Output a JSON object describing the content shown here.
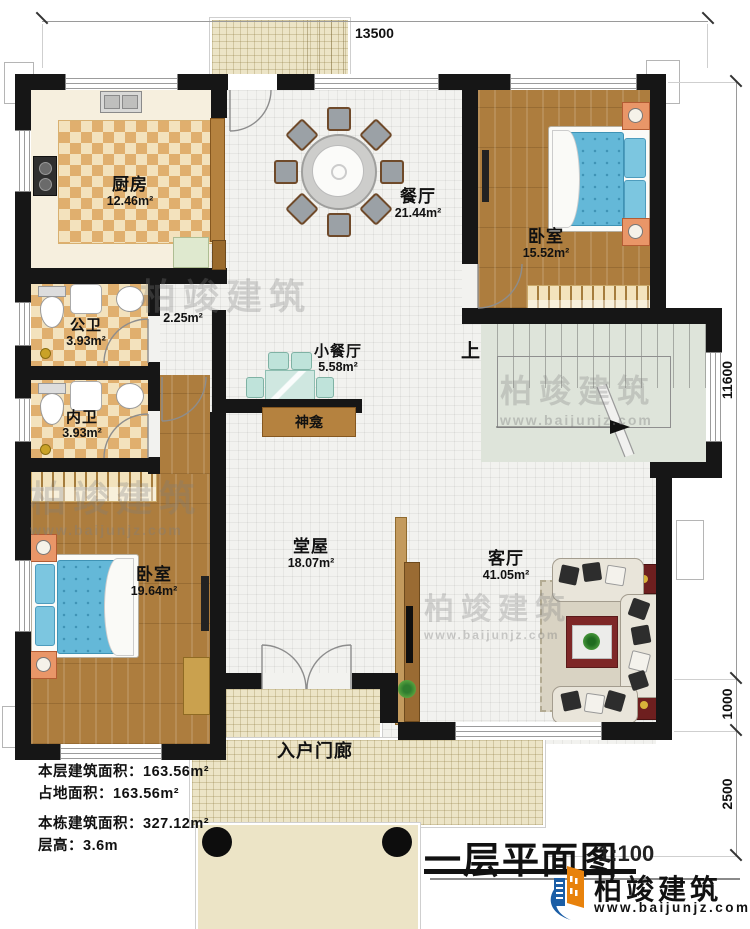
{
  "title_block": {
    "title": "一层平面图",
    "scale": "1:100",
    "brand": "柏竣建筑",
    "website": "www.baijunjz.com"
  },
  "watermark": {
    "brand": "柏竣建筑",
    "website": "www.baijunjz.com"
  },
  "info": {
    "line1": "本层建筑面积：163.56m²",
    "line2": "占地面积：163.56m²",
    "line3": "本栋建筑面积：327.12m²",
    "line4": "层高：3.6m"
  },
  "dimensions": {
    "top": "13500",
    "right_upper": "11600",
    "right_mid": "1000",
    "right_lower": "2500"
  },
  "rooms": {
    "kitchen": {
      "name": "厨房",
      "area": "12.46m²"
    },
    "dining": {
      "name": "餐厅",
      "area": "21.44m²"
    },
    "bedroom1": {
      "name": "卧室",
      "area": "15.52m²"
    },
    "public_bath": {
      "name": "公卫",
      "area": "3.93m²"
    },
    "corridor": {
      "area": "2.25m²"
    },
    "inner_bath": {
      "name": "内卫",
      "area": "3.93m²"
    },
    "small_dining": {
      "name": "小餐厅",
      "area": "5.58m²"
    },
    "shrine": {
      "name": "神龛"
    },
    "bedroom2": {
      "name": "卧室",
      "area": "19.64m²"
    },
    "hall": {
      "name": "堂屋",
      "area": "18.07m²"
    },
    "living": {
      "name": "客厅",
      "area": "41.05m²"
    },
    "porch": {
      "name": "入户门廊"
    },
    "stairs": {
      "up_label": "上"
    }
  },
  "colors": {
    "wall": "#161616",
    "wood_floor": "#ad7d3e",
    "checker_tile": "#e0af6e",
    "mattress_blue": "#64b8d8",
    "stairs_floor": "#dee4da",
    "porch_floor": "#ece4c6",
    "brand_blue": "#1b5ea6",
    "brand_orange": "#e8820c"
  }
}
